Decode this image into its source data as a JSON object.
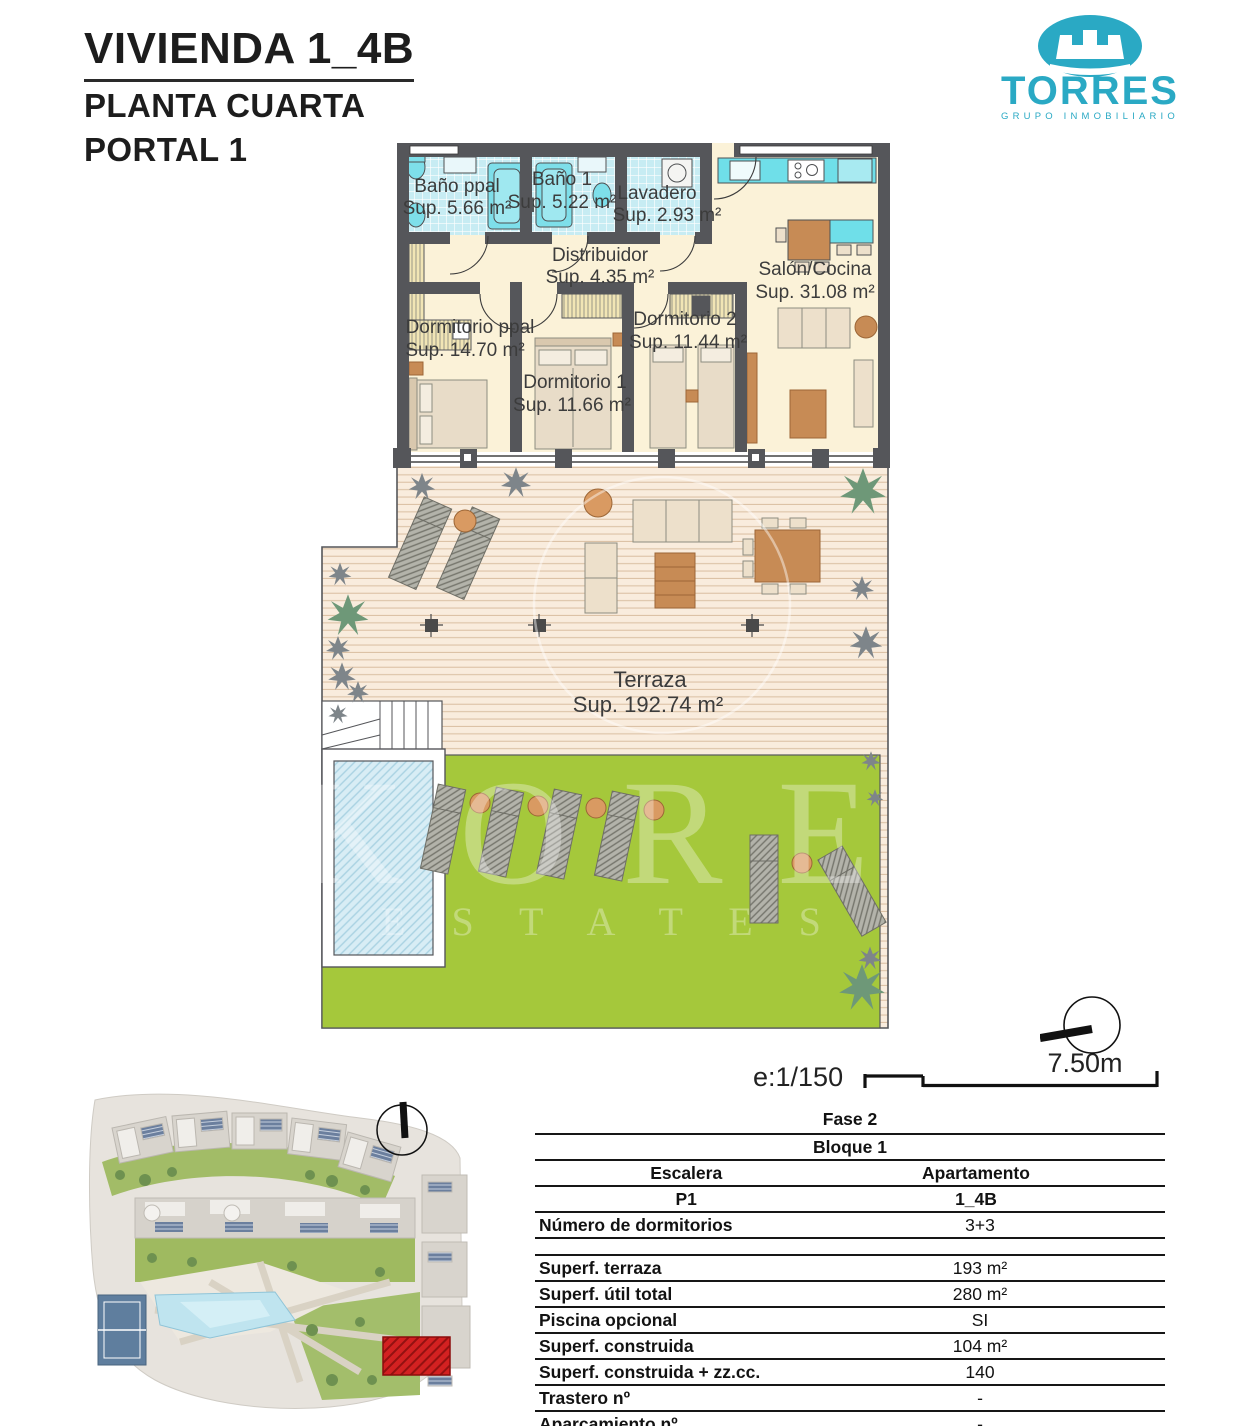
{
  "header": {
    "title": "VIVIENDA 1_4B",
    "subtitle1": "PLANTA CUARTA",
    "subtitle2": "PORTAL 1"
  },
  "logo": {
    "name": "TORRES",
    "tagline": "GRUPO INMOBILIARIO",
    "brand_color": "#2AA9C4"
  },
  "floorplan": {
    "rooms": {
      "bano_ppal": {
        "label": "Baño ppal",
        "sup": "Sup. 5.66 m²"
      },
      "bano_1": {
        "label": "Baño 1",
        "sup": "Sup. 5.22 m²"
      },
      "lavadero": {
        "label": "Lavadero",
        "sup": "Sup. 2.93 m²"
      },
      "distribuidor": {
        "label": "Distribuidor",
        "sup": "Sup. 4.35 m²"
      },
      "salon_cocina": {
        "label": "Salón/Cocina",
        "sup": "Sup. 31.08 m²"
      },
      "dormitorio_ppal": {
        "label": "Dormitorio ppal",
        "sup": "Sup. 14.70 m²"
      },
      "dormitorio_1": {
        "label": "Dormitorio 1",
        "sup": "Sup. 11.66 m²"
      },
      "dormitorio_2": {
        "label": "Dormitorio 2",
        "sup": "Sup. 11.44 m²"
      },
      "terraza": {
        "label": "Terraza",
        "sup": "Sup. 192.74 m²"
      }
    },
    "scale_label": "e:1/150",
    "scale_length": "7.50m",
    "watermark_line1": "KORE",
    "watermark_line2": "E S T A T E S",
    "colors": {
      "lawn_green": "#A5C83B",
      "pool_blue": "#D8EDF5",
      "deck_wood": "#F9ECDD",
      "tile_teal": "#C7ECF3",
      "highlight_red": "#D32121"
    }
  },
  "bottom_table": {
    "fase": "Fase 2",
    "bloque": "Bloque 1",
    "escalera_header": "Escalera",
    "apartamento_header": "Apartamento",
    "escalera_value": "P1",
    "apartamento_value": "1_4B",
    "rows": [
      {
        "label": "Número de dormitorios",
        "value": "3+3"
      },
      {
        "label": "Superf. terraza",
        "value": "193 m²"
      },
      {
        "label": "Superf. útil total",
        "value": "280 m²"
      },
      {
        "label": "Piscina opcional",
        "value": "SI"
      },
      {
        "label": "Superf. construida",
        "value": "104 m²"
      },
      {
        "label": "Superf. construida + zz.cc.",
        "value": "140"
      },
      {
        "label": "Trastero nº",
        "value": "-"
      },
      {
        "label": "Aparcamiento nº",
        "value": "-"
      }
    ]
  }
}
